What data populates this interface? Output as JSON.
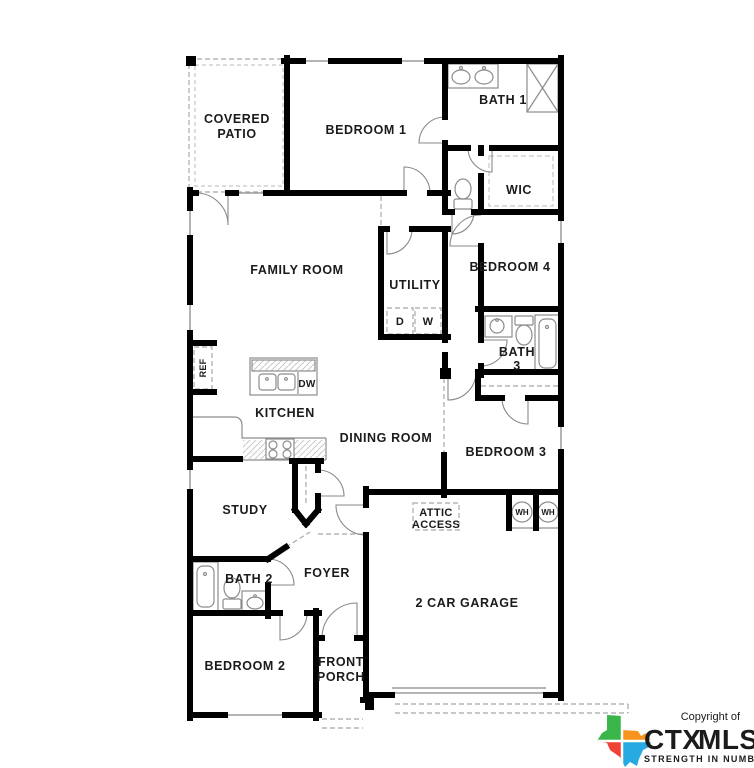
{
  "plan": {
    "rooms": {
      "covered_patio_line1": "COVERED",
      "covered_patio_line2": "PATIO",
      "bedroom1": "BEDROOM 1",
      "bath1": "BATH 1",
      "wic": "WIC",
      "family_room": "FAMILY ROOM",
      "utility": "UTILITY",
      "bedroom4": "BEDROOM 4",
      "bath3_line1": "BATH",
      "bath3_line2": "3",
      "bedroom3": "BEDROOM 3",
      "kitchen": "KITCHEN",
      "dining_room": "DINING ROOM",
      "study": "STUDY",
      "foyer": "FOYER",
      "bath2": "BATH 2",
      "bedroom2": "BEDROOM 2",
      "front_porch_line1": "FRONT",
      "front_porch_line2": "PORCH",
      "garage": "2 CAR GARAGE",
      "attic_line1": "ATTIC",
      "attic_line2": "ACCESS"
    },
    "appliances": {
      "dryer": "D",
      "washer": "W",
      "dishwasher": "DW",
      "refrigerator": "REF",
      "water_heater": "WH"
    }
  },
  "logo": {
    "copyright": "Copyright of",
    "brand_ctx": "CTX",
    "brand_mls": "MLS",
    "tagline": "STRENGTH IN NUMBERS",
    "colors": {
      "orange": "#F7941E",
      "blue": "#1C75BC",
      "green": "#3AB54A",
      "tx_green": "#3AB54A",
      "tx_orange": "#F7941E",
      "tx_red": "#EF4136",
      "tx_cyan": "#27AAE1"
    }
  }
}
